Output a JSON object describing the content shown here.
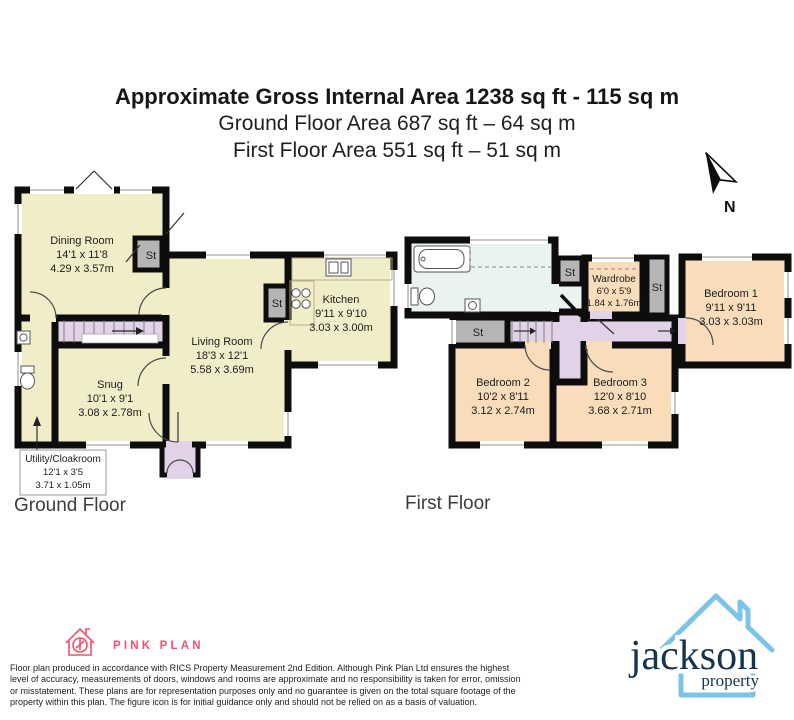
{
  "header": {
    "title": "Approximate Gross Internal Area 1238 sq ft - 115 sq m",
    "subtitle_ground": "Ground Floor Area 687 sq ft – 64 sq m",
    "subtitle_first": "First Floor Area 551 sq ft – 51 sq m"
  },
  "compass": {
    "north_label": "N"
  },
  "labels": {
    "st": "St"
  },
  "ground_floor": {
    "label": "Ground Floor",
    "rooms": [
      {
        "name": "Dining Room",
        "dims_ft": "14'1 x 11'8",
        "dims_m": "4.29 x 3.57m"
      },
      {
        "name": "Living Room",
        "dims_ft": "18'3 x 12'1",
        "dims_m": "5.58 x 3.69m"
      },
      {
        "name": "Kitchen",
        "dims_ft": "9'11 x 9'10",
        "dims_m": "3.03 x 3.00m"
      },
      {
        "name": "Snug",
        "dims_ft": "10'1 x 9'1",
        "dims_m": "3.08 x 2.78m"
      },
      {
        "name": "Utility/Cloakroom",
        "dims_ft": "12'1 x 3'5",
        "dims_m": "3.71 x 1.05m"
      }
    ]
  },
  "first_floor": {
    "label": "First Floor",
    "rooms": [
      {
        "name": "Bedroom 1",
        "dims_ft": "9'11 x 9'11",
        "dims_m": "3.03 x 3.03m"
      },
      {
        "name": "Bedroom 2",
        "dims_ft": "10'2 x 8'11",
        "dims_m": "3.12 x 2.74m"
      },
      {
        "name": "Bedroom 3",
        "dims_ft": "12'0 x 8'10",
        "dims_m": "3.68 x 2.71m"
      },
      {
        "name": "Wardrobe",
        "dims_ft": "6'0 x 5'9",
        "dims_m": "1.84 x 1.76m"
      }
    ]
  },
  "footer": {
    "pinkplan_name": "PINK PLAN",
    "disclaimer_lines": [
      "Floor plan produced in accordance with RICS Property Measurement 2nd Edition. Although Pink Plan Ltd ensures the highest",
      "level of accuracy, measurements of doors, windows and rooms are approximate and no responsibility is taken for error, omission",
      "or misstatement. These plans are for representation purposes only and no guarantee is given on the total square footage of the",
      "property within this plan. The figure icon is for initial guidance only and should not be relied on as a basis of valuation."
    ],
    "jackson_name": "jackson",
    "jackson_sub": "property"
  },
  "colors": {
    "room_cream": "#f1edc9",
    "room_peach": "#f9dcba",
    "stairs_lilac": "#e2d2e7",
    "bathroom_blue": "#e9f4ef",
    "closet_gray": "#b5b5b5",
    "wall": "#0d0d0d",
    "pink": "#f2516f",
    "jackson_navy": "#15344e",
    "jackson_blue": "#7cc3e8"
  }
}
